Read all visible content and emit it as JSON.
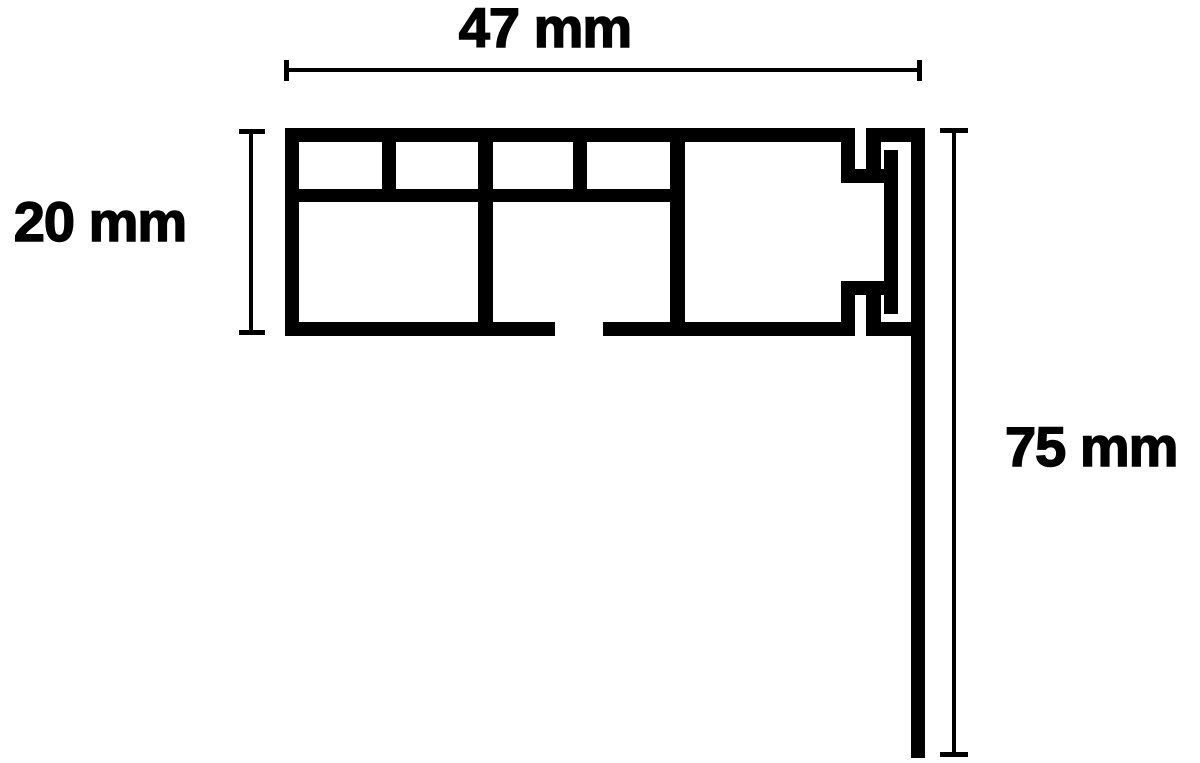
{
  "diagram": {
    "type": "technical-cross-section",
    "background_color": "#ffffff",
    "ink_color": "#000000",
    "dimensions": [
      {
        "id": "width",
        "label": "47 mm",
        "value": 47,
        "unit": "mm",
        "orientation": "horizontal",
        "position": "top"
      },
      {
        "id": "height",
        "label": "20 mm",
        "value": 20,
        "unit": "mm",
        "orientation": "vertical",
        "position": "left"
      },
      {
        "id": "drop",
        "label": "75 mm",
        "value": 75,
        "unit": "mm",
        "orientation": "vertical",
        "position": "right"
      }
    ]
  }
}
